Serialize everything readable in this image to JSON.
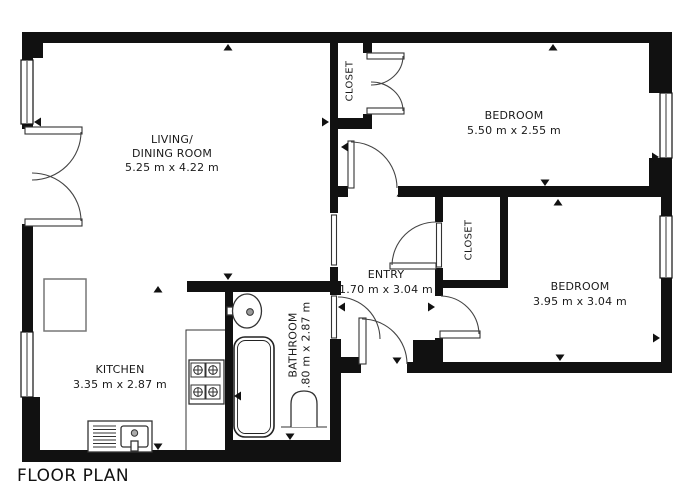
{
  "title": "FLOOR PLAN",
  "rooms": {
    "living": {
      "line1": "LIVING/",
      "line2": "DINING ROOM",
      "dims": "5.25 m x 4.22 m"
    },
    "bedroom1": {
      "name": "BEDROOM",
      "dims": "5.50 m x 2.55 m"
    },
    "bedroom2": {
      "name": "BEDROOM",
      "dims": "3.95 m x 3.04 m"
    },
    "entry": {
      "name": "ENTRY",
      "dims": "1.70 m x 3.04 m"
    },
    "kitchen": {
      "name": "KITCHEN",
      "dims": "3.35 m x 2.87 m"
    },
    "bathroom": {
      "name": "BATHROOM",
      "dims": ".80 m x 2.87 m"
    },
    "closet_top": {
      "name": "CLOSET"
    },
    "closet_middle": {
      "name": "CLOSET"
    }
  },
  "fixtures": [
    "refrigerator",
    "kitchen-counter",
    "stove",
    "kitchen-sink",
    "bathtub",
    "bathroom-sink",
    "toilet",
    "windows",
    "doors"
  ],
  "colors": {
    "wall": "#111111",
    "fixture_line": "#333333",
    "text": "#1a1a1a",
    "background": "#ffffff"
  }
}
